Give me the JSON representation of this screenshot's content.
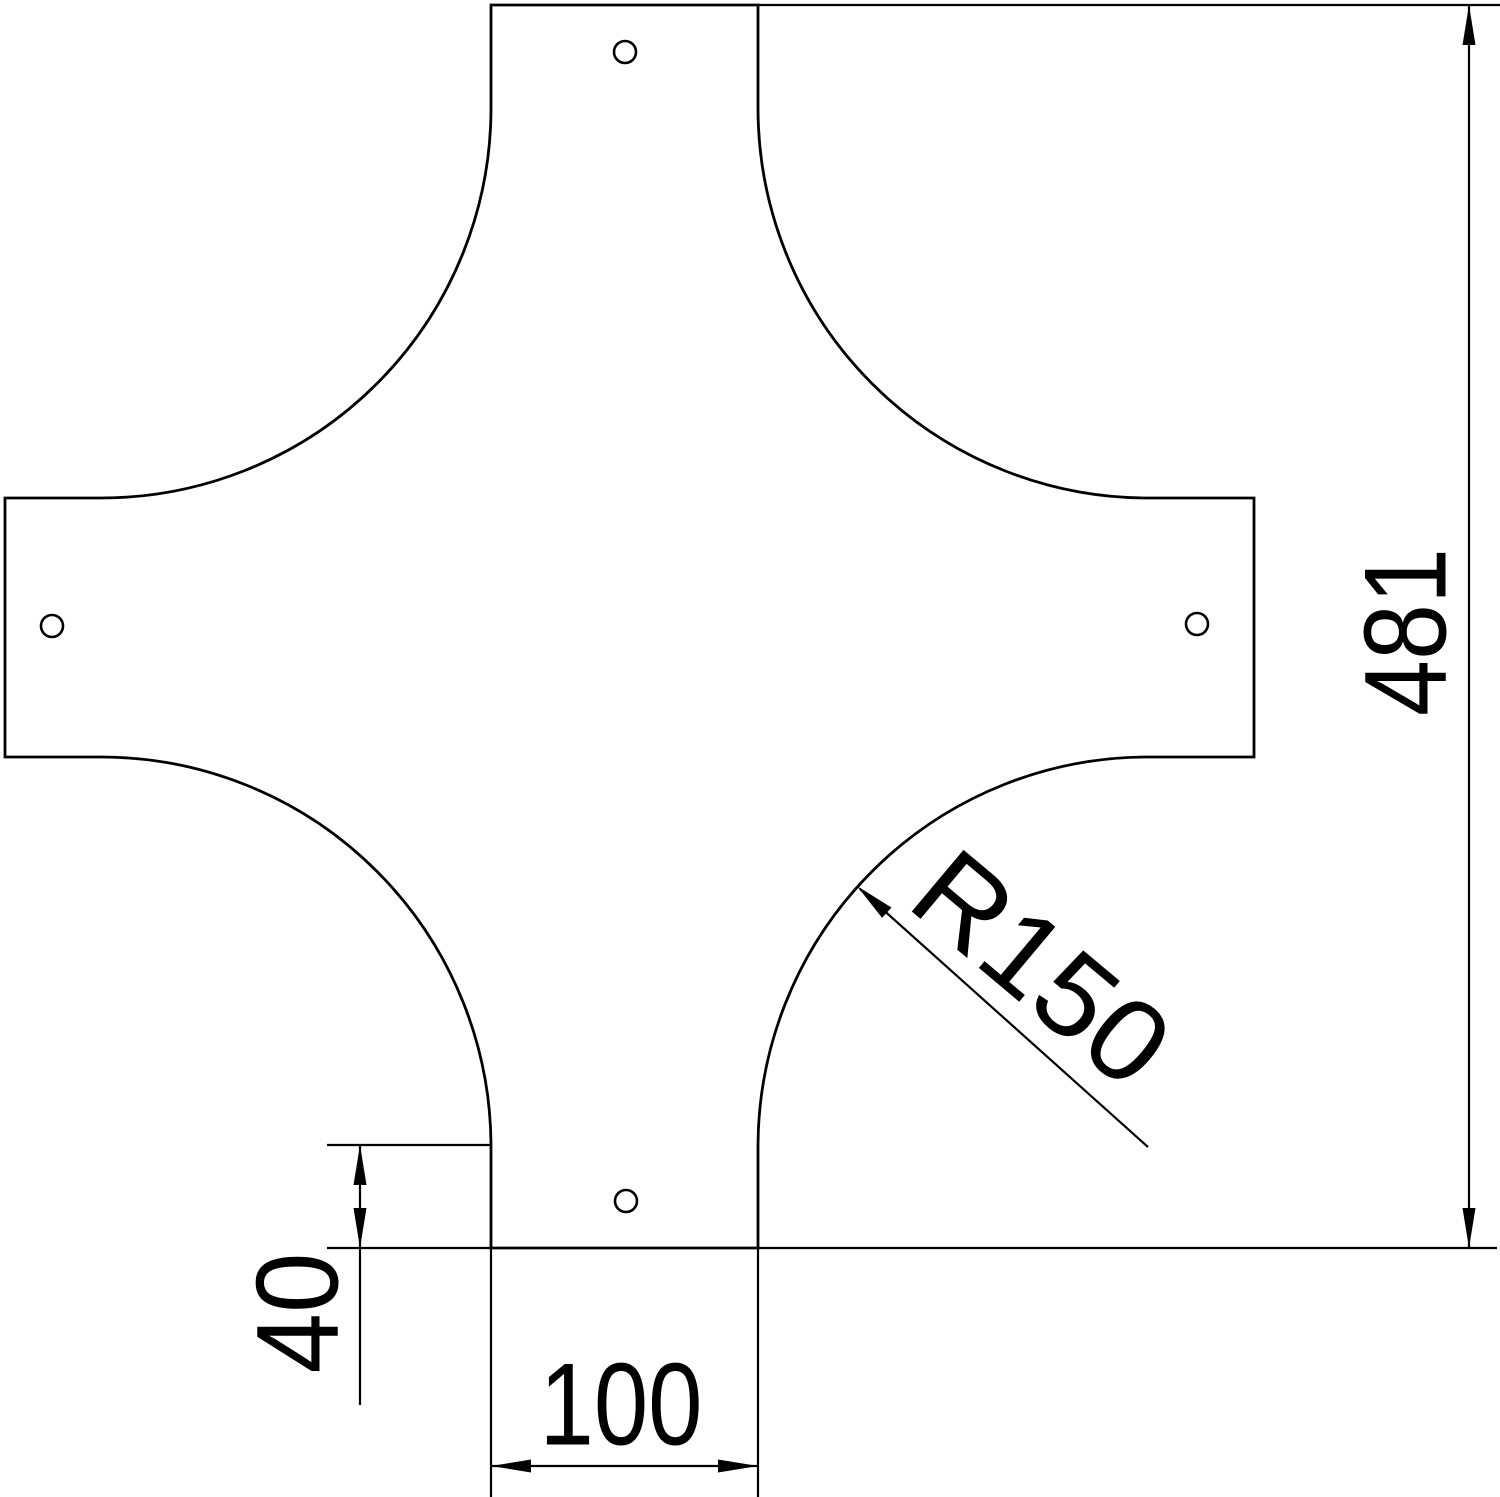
{
  "page": {
    "background": "#ffffff",
    "line_color": "#000000"
  },
  "drawing": {
    "labels": {
      "overall_length": "481",
      "arm_width": "100",
      "edge_offset": "40",
      "corner_radius": "R150"
    }
  }
}
